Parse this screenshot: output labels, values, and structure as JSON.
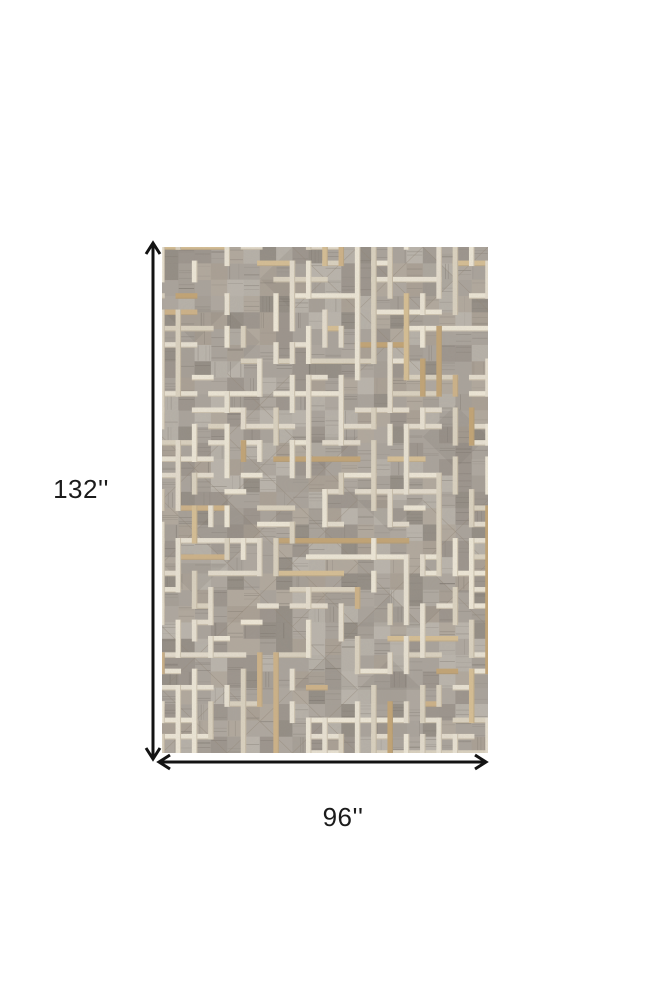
{
  "figure": {
    "background_color": "#ffffff",
    "alt": "Dimension diagram of a rectangular area rug shown from above"
  },
  "dimensions": {
    "height_label": "132''",
    "width_label": "96''",
    "arrow_color": "#131313",
    "label_color": "#1b1b1b"
  },
  "rug": {
    "alt": "Gray, ivory and tan geometric maze patterned patchwork hide rug",
    "width_px": 326,
    "height_px": 506,
    "fine_cols": 20,
    "fine_rows": 31,
    "coarse_cols": 5,
    "coarse_rows": 8,
    "seed": 11,
    "base_color": "#a9a29a",
    "patch_colors": [
      "#b8b2aa",
      "#aea79f",
      "#a49d95",
      "#999189",
      "#8f8880",
      "#b1a89c",
      "#a89f92",
      "#bdb7ae"
    ],
    "striation_color": "#6e675f",
    "seam_color": "#8f8272",
    "shade_color": "#6b645c",
    "strip_colors": [
      "#ece5d5",
      "#e7dfcf",
      "#f1ead9",
      "#ddd4c1"
    ],
    "accent_strip_colors": [
      "#cfb285",
      "#c3a371",
      "#d8bf92"
    ],
    "strip_shadow_color": "#a08f72",
    "strip_thickness": 5.5,
    "edge_start_prob": 0.38,
    "edge_stay_prob": 0.55,
    "edge_turnon_prob": 0.28,
    "accent_prob": 0.17,
    "diagonal_prob": 0.5,
    "triangle_prob": 0.35
  }
}
